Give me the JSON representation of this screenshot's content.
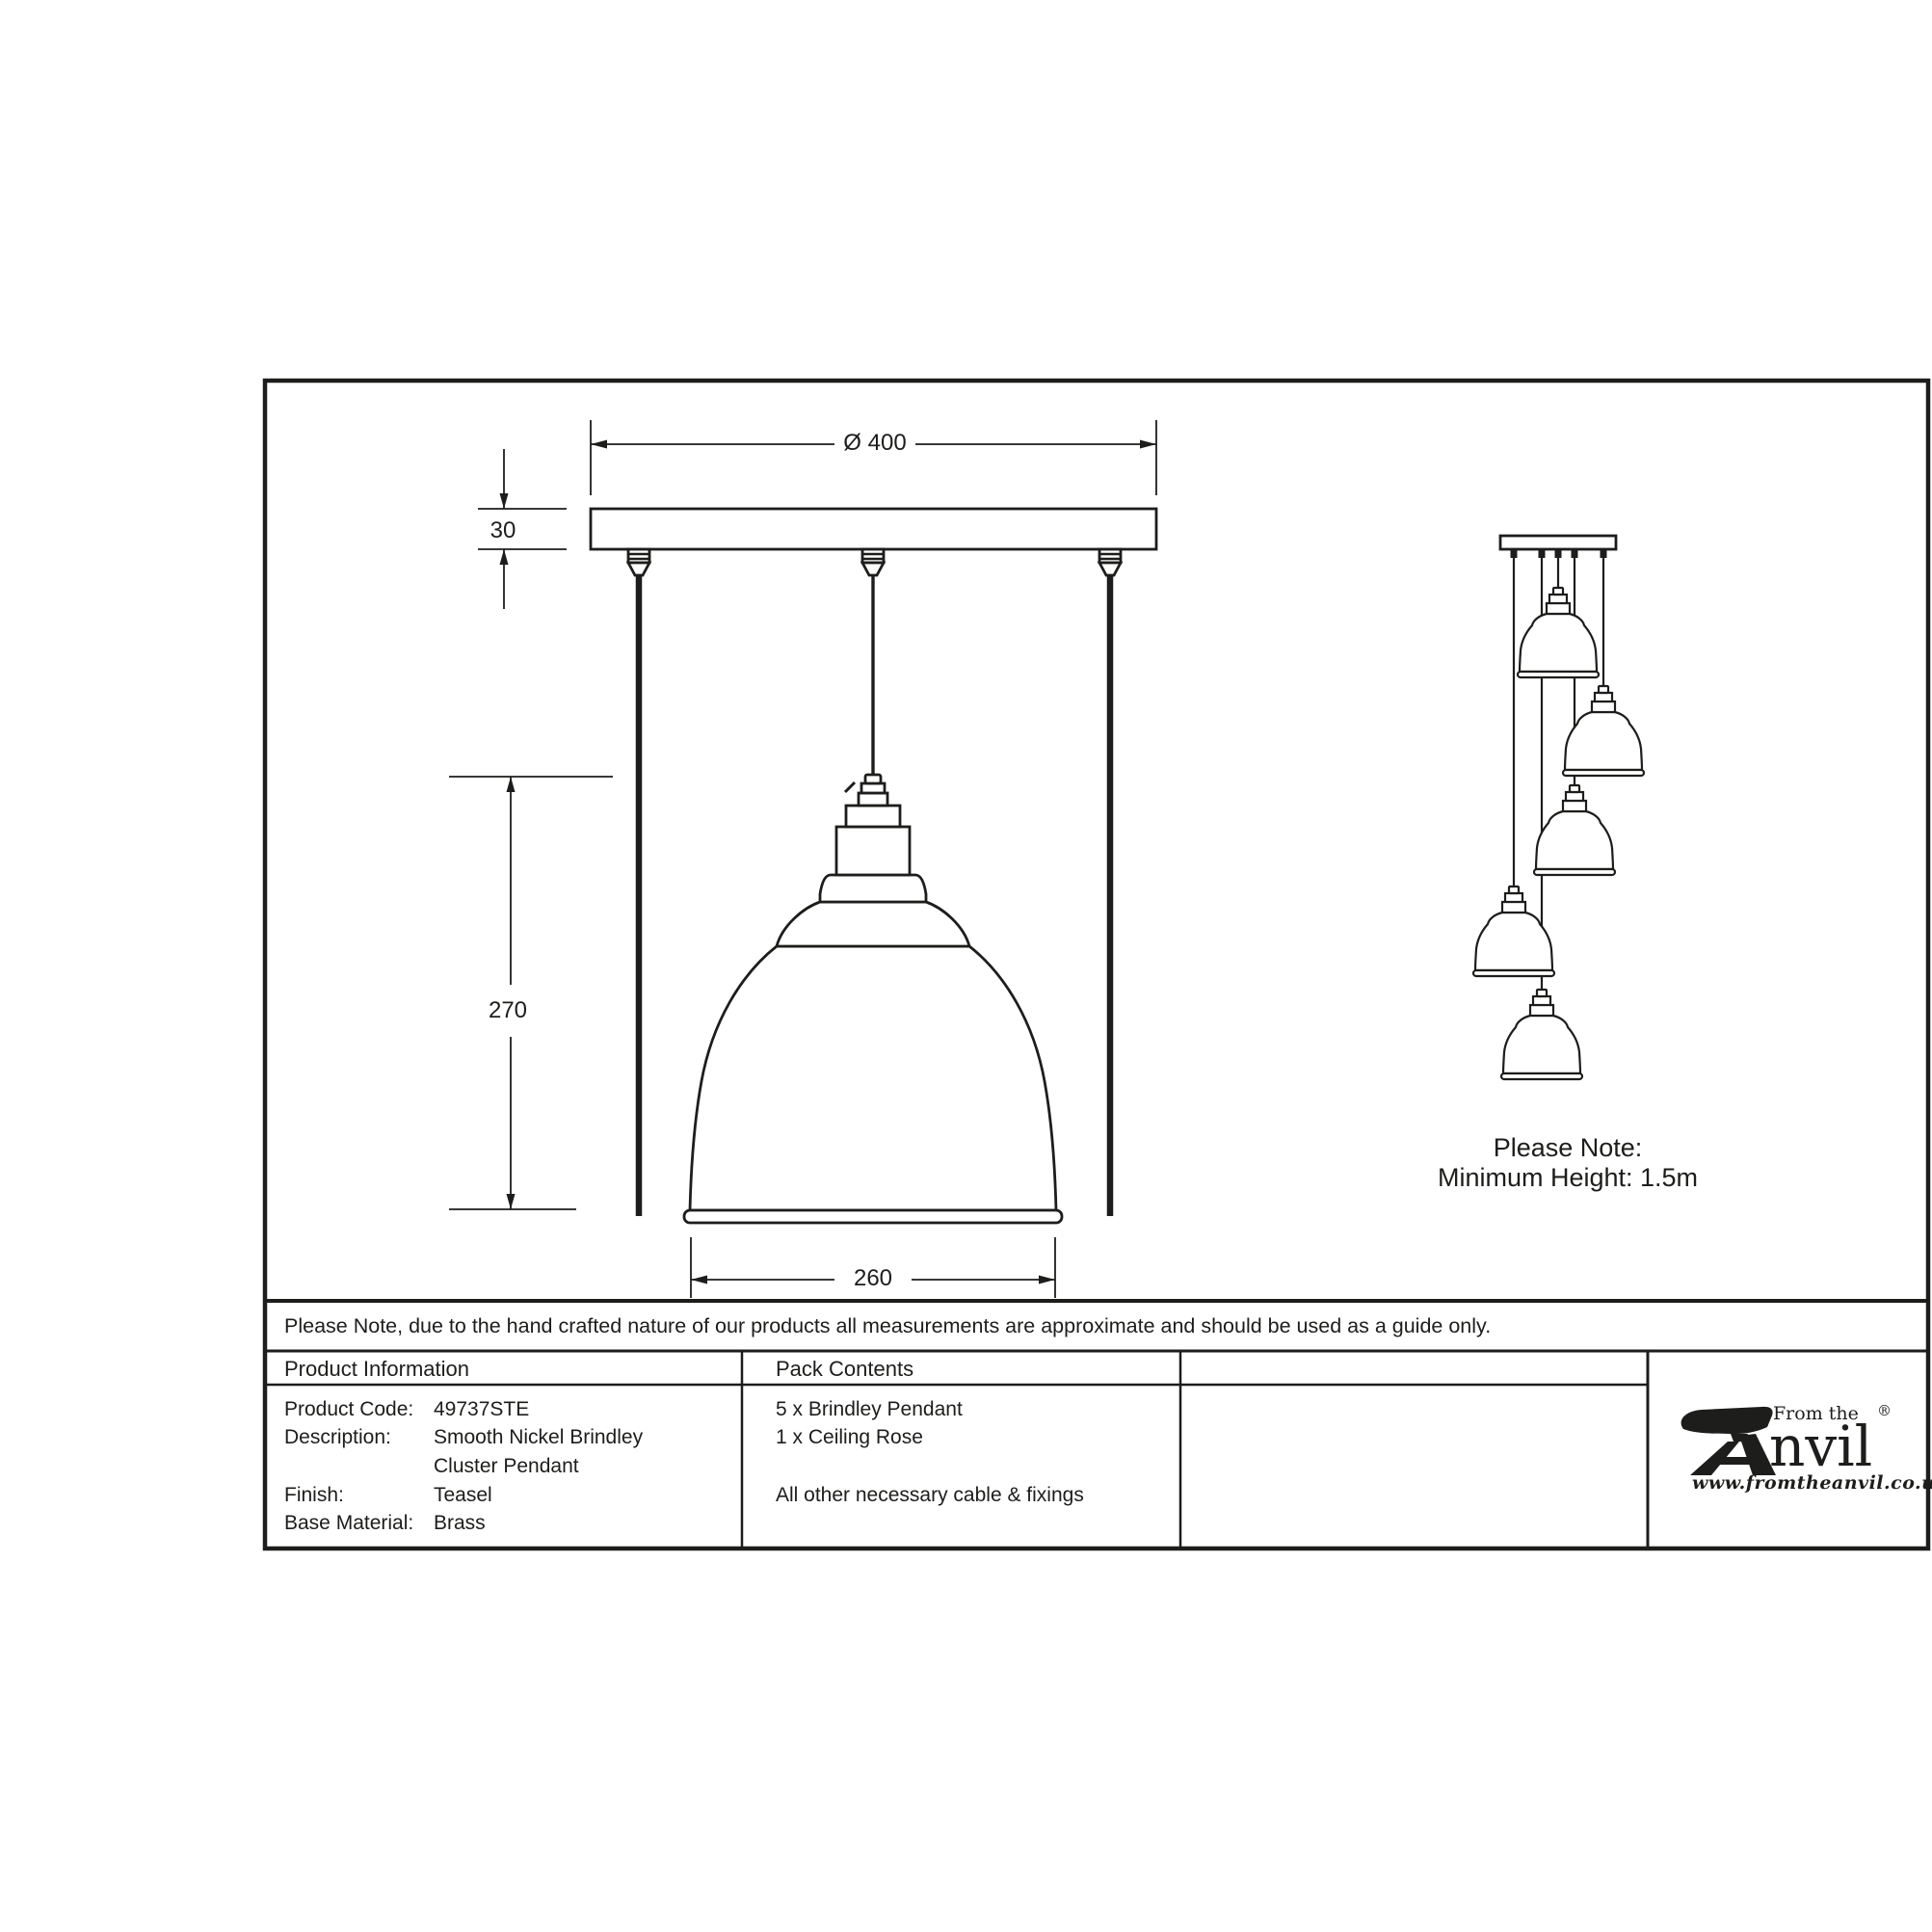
{
  "colors": {
    "ink": "#1d1d1b",
    "background": "#ffffff"
  },
  "sheet": {
    "dimensions": {
      "plate_diameter": "Ø 400",
      "plate_height": "30",
      "pendant_height": "270",
      "shade_diameter": "260"
    },
    "cluster_note": {
      "line1": "Please Note:",
      "line2": "Minimum Height: 1.5m"
    },
    "footer_note": "Please Note, due to the hand crafted nature of our products all measurements are approximate and should be used as a guide only.",
    "table": {
      "product_information": {
        "header": "Product Information",
        "rows": [
          {
            "label": "Product Code:",
            "value": "49737STE"
          },
          {
            "label": "Description:",
            "value": "Smooth Nickel Brindley"
          },
          {
            "label": "",
            "value": "Cluster Pendant"
          },
          {
            "label": "Finish:",
            "value": "Teasel"
          },
          {
            "label": "Base Material:",
            "value": "Brass"
          }
        ]
      },
      "pack_contents": {
        "header": "Pack Contents",
        "items": [
          "5 x Brindley Pendant",
          "1 x Ceiling Rose",
          "All other necessary cable & fixings"
        ]
      }
    },
    "logo": {
      "prefix": "From the",
      "name_rest": "nvil",
      "registered": "®",
      "url": "www.fromtheanvil.co.uk"
    }
  }
}
